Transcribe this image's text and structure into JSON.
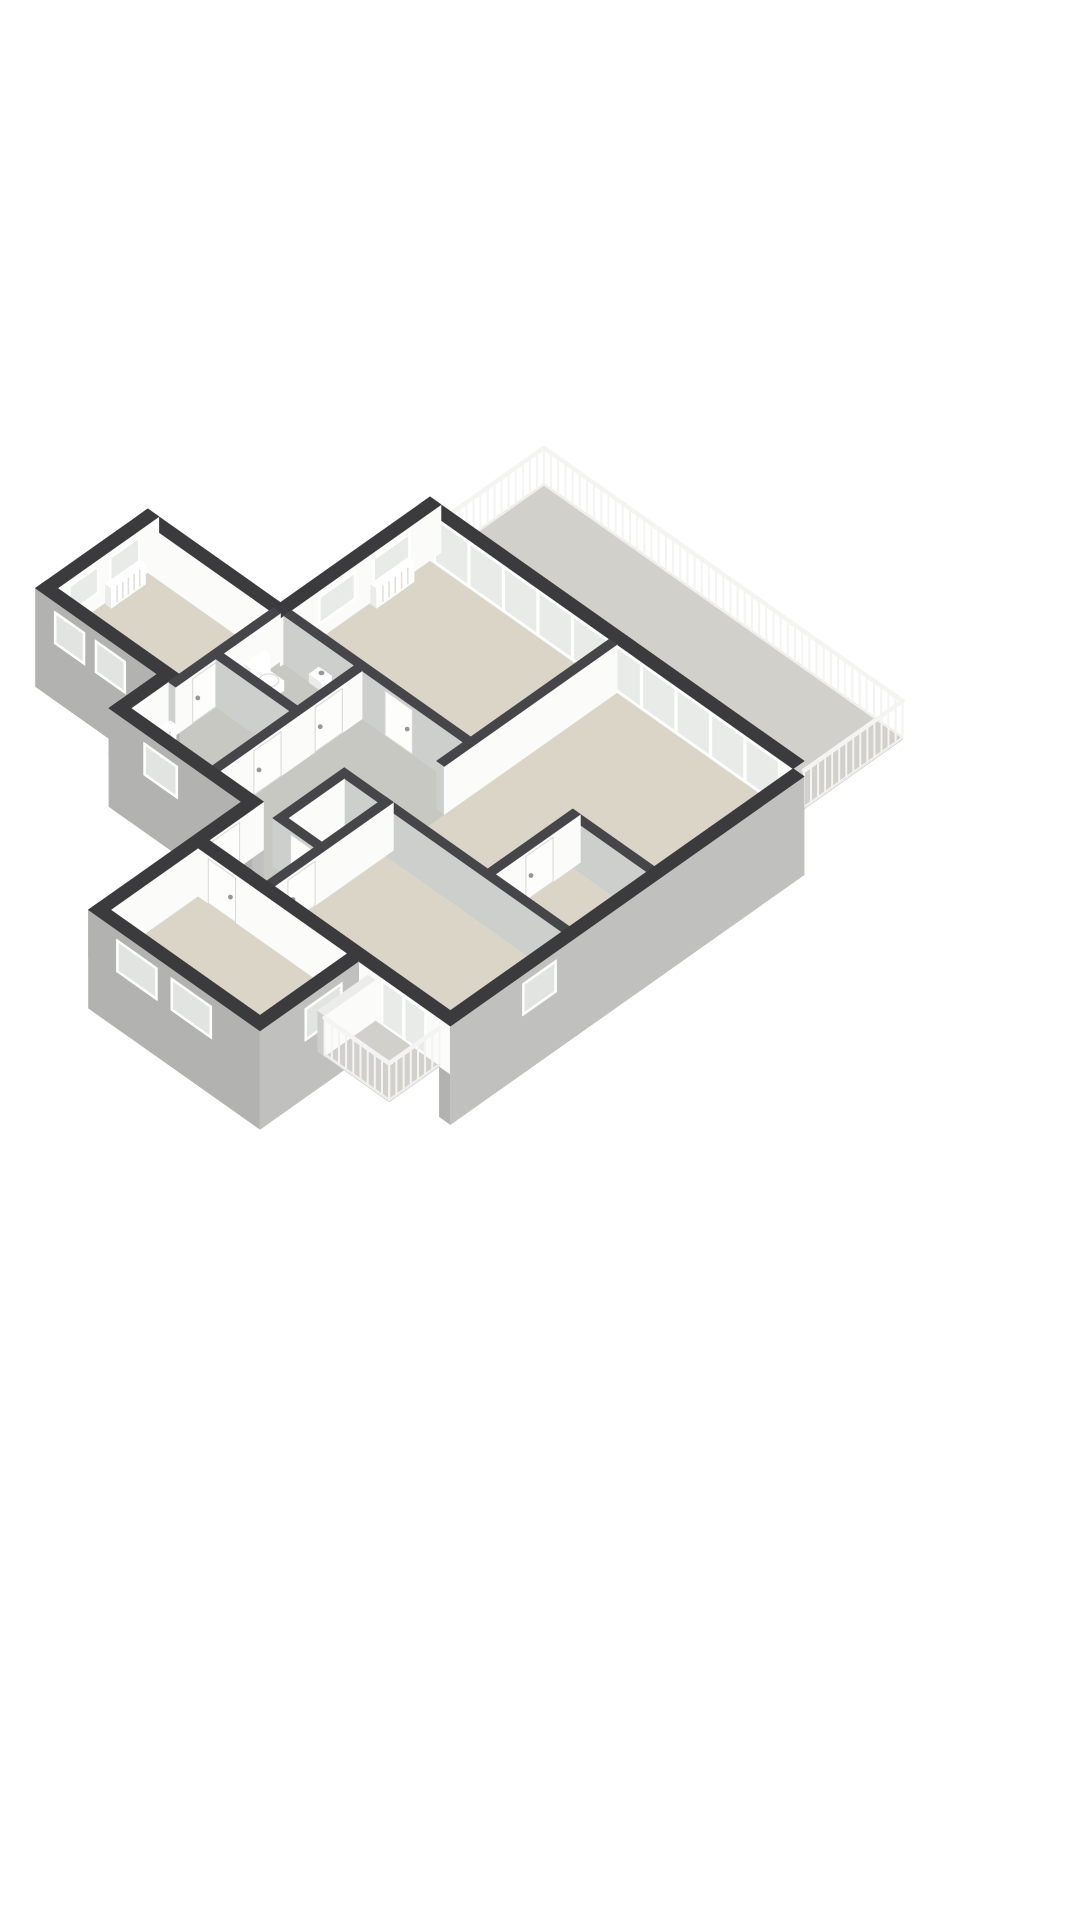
{
  "page": {
    "background": "#ffffff",
    "kind": "3d-floorplan-render"
  },
  "projection": {
    "cx": 430,
    "cy": 545,
    "kx": 34,
    "ky": 24,
    "wall_px": 48
  },
  "colors": {
    "wallTop": "#3b3b3d",
    "wallTopInt": "#46464a",
    "faceWhite": "#fbfbfa",
    "faceLight": "#cdcfcd",
    "extGraySW": "#b2b2b0",
    "extGraySE": "#c0c0be",
    "floorRoom": "#dad5c7",
    "floorWet": "#c7c8c1",
    "floorOut": "#d1d0ca",
    "glass": "#e9ebe9",
    "glassExt": "#e2e4e2",
    "frame": "#ffffff",
    "slabEdge": "#ececea",
    "railing": "#f4f4f3",
    "doorLeaf": "#fdfdfc",
    "doorEdge": "#d8d8d5",
    "handle": "#97979a",
    "fixture": "#ffffff",
    "fixtureShade": "#ebebe9",
    "radSlat": "#dededb"
  },
  "elements": [
    {
      "t": "floor",
      "name": "terrace-floor",
      "pts": [
        [
          0.45,
          0
        ],
        [
          11,
          0
        ],
        [
          11,
          -2.9
        ],
        [
          0.45,
          -2.9
        ]
      ],
      "fill": "floorOut"
    },
    {
      "t": "railing",
      "name": "terrace-railing",
      "pts": [
        [
          0.45,
          0
        ],
        [
          0.45,
          -2.9
        ],
        [
          11,
          -2.9
        ],
        [
          11,
          0
        ]
      ],
      "z1": 0.8,
      "step": 0.21
    },
    {
      "t": "floor",
      "name": "sitting-room-floor",
      "pts": [
        [
          0,
          0
        ],
        [
          5.82,
          0
        ],
        [
          5.82,
          4.62
        ],
        [
          0,
          4.62
        ]
      ],
      "fill": "floorRoom"
    },
    {
      "t": "floor",
      "name": "living-room-floor",
      "pts": [
        [
          5.6,
          0
        ],
        [
          11,
          0
        ],
        [
          11,
          6.9
        ],
        [
          5.6,
          6.9
        ]
      ],
      "fill": "floorRoom"
    },
    {
      "t": "floor",
      "name": "bedroom1-floor",
      "pts": [
        [
          -3.9,
          4.4
        ],
        [
          0.22,
          4.4
        ],
        [
          0.22,
          7.7
        ],
        [
          -3.9,
          7.7
        ]
      ],
      "fill": "floorRoom"
    },
    {
      "t": "floor",
      "name": "wc-floor",
      "pts": [
        [
          0,
          4.4
        ],
        [
          2.62,
          4.4
        ],
        [
          2.62,
          6.52
        ],
        [
          0,
          6.52
        ]
      ],
      "fill": "floorWet"
    },
    {
      "t": "floor",
      "name": "bathroom-floor",
      "pts": [
        [
          0,
          6.3
        ],
        [
          2.62,
          6.3
        ],
        [
          2.62,
          8.8
        ],
        [
          0,
          8.8
        ]
      ],
      "fill": "floorWet"
    },
    {
      "t": "floor",
      "name": "hallway-floor",
      "pts": [
        [
          2.4,
          4.4
        ],
        [
          5.82,
          4.4
        ],
        [
          5.82,
          8.8
        ],
        [
          2.4,
          8.8
        ]
      ],
      "fill": "floorWet"
    },
    {
      "t": "floor",
      "name": "corridor-floor",
      "pts": [
        [
          3.9,
          8.8
        ],
        [
          5.82,
          8.8
        ],
        [
          5.82,
          10.4
        ],
        [
          3.9,
          10.4
        ]
      ],
      "fill": "floorWet"
    },
    {
      "t": "floor",
      "name": "storage-floor",
      "pts": [
        [
          4.38,
          6.9
        ],
        [
          5.82,
          6.9
        ],
        [
          5.82,
          9
        ],
        [
          4.38,
          9
        ]
      ],
      "fill": "floorWet"
    },
    {
      "t": "floor",
      "name": "bedroom2-floor",
      "pts": [
        [
          5.6,
          6.9
        ],
        [
          11,
          6.9
        ],
        [
          11,
          10.4
        ],
        [
          5.6,
          10.4
        ]
      ],
      "fill": "floorRoom"
    },
    {
      "t": "floor",
      "name": "bedroom3-floor",
      "pts": [
        [
          3.9,
          10.4
        ],
        [
          8.3,
          10.4
        ],
        [
          8.3,
          13.3
        ],
        [
          3.9,
          13.3
        ]
      ],
      "fill": "floorRoom"
    },
    {
      "t": "box",
      "name": "wall-ne-glazed",
      "u1": 0,
      "v1": 0,
      "u2": 11,
      "v2": 0.32,
      "z0": 0,
      "z1": 1,
      "top": "wallTop",
      "sw": "faceWhite",
      "se": null
    },
    {
      "t": "panels",
      "name": "terrace-glazing",
      "axis": "u",
      "at": 0.32,
      "from": 0.45,
      "to": 10.6,
      "n": 10,
      "z0": 0.02,
      "z1": 0.96,
      "frame": "frame",
      "glass": "glass"
    },
    {
      "t": "box",
      "name": "wall-nw-main",
      "u1": 0,
      "v1": 0,
      "u2": 0.32,
      "v2": 4.72,
      "z0": 0,
      "z1": 1,
      "top": "wallTop",
      "se": "faceWhite",
      "sw": "faceLight"
    },
    {
      "t": "window",
      "name": "sitting-window-1",
      "axis": "v",
      "at": 0.32,
      "from": 0.9,
      "to": 2.0,
      "z0": 0.28,
      "z1": 0.88,
      "frame": "frame",
      "glass": "glass"
    },
    {
      "t": "window",
      "name": "sitting-window-2",
      "axis": "v",
      "at": 0.32,
      "from": 2.5,
      "to": 3.6,
      "z0": 0.28,
      "z1": 0.88,
      "frame": "frame",
      "glass": "glass"
    },
    {
      "t": "radiator",
      "name": "radiator-sitting-room",
      "axis": "v",
      "at": 0.36,
      "from": 1.0,
      "to": 2.1,
      "z1": 0.42
    },
    {
      "t": "box",
      "name": "wall-wing-ne",
      "u1": -3.9,
      "v1": 4.4,
      "u2": 0,
      "v2": 4.72,
      "z0": 0,
      "z1": 1,
      "top": "wallTop",
      "sw": "faceWhite",
      "se": null
    },
    {
      "t": "box",
      "name": "wall-wing-nw",
      "u1": -3.9,
      "v1": 4.4,
      "u2": -3.58,
      "v2": 7.7,
      "z0": 0,
      "z1": 1,
      "top": "wallTop",
      "se": "faceWhite",
      "sw": null
    },
    {
      "t": "window",
      "name": "bedroom1-window-1",
      "axis": "v",
      "at": -3.58,
      "from": 4.95,
      "to": 5.85,
      "z0": 0.28,
      "z1": 0.88,
      "frame": "frame",
      "glass": "glass"
    },
    {
      "t": "window",
      "name": "bedroom1-window-2",
      "axis": "v",
      "at": -3.58,
      "from": 6.15,
      "to": 7.05,
      "z0": 0.28,
      "z1": 0.88,
      "frame": "frame",
      "glass": "glass"
    },
    {
      "t": "radiator",
      "name": "radiator-bedroom1",
      "axis": "v",
      "at": -3.54,
      "from": 5.0,
      "to": 6.0,
      "z1": 0.42
    },
    {
      "t": "box",
      "name": "wall-wing-sw-facade",
      "u1": -3.9,
      "v1": 7.38,
      "u2": 0.32,
      "v2": 7.7,
      "z0": -1.05,
      "z1": 1,
      "top": "wallTop",
      "sw": "extGraySW",
      "se": null
    },
    {
      "t": "window",
      "name": "facade-window-west-1",
      "axis": "u",
      "at": 7.7,
      "from": -3.35,
      "to": -2.45,
      "z0": 0.12,
      "z1": 0.8,
      "frame": "frame",
      "glass": "glassExt"
    },
    {
      "t": "window",
      "name": "facade-window-west-2",
      "axis": "u",
      "at": 7.7,
      "from": -2.15,
      "to": -1.25,
      "z0": 0.12,
      "z1": 0.8,
      "frame": "frame",
      "glass": "glassExt"
    },
    {
      "t": "box",
      "name": "wall-wc-west",
      "u1": 0,
      "v1": 4.62,
      "u2": 0.22,
      "v2": 7.7,
      "z0": 0,
      "z1": 1,
      "top": "wallTopInt",
      "se": "faceWhite",
      "sw": "faceLight"
    },
    {
      "t": "door",
      "name": "door-bedroom1",
      "axis": "v",
      "at": 0.22,
      "from": 6.4,
      "to": 7.2,
      "z1": 0.92
    },
    {
      "t": "box",
      "name": "wall-hall-north",
      "u1": 0.32,
      "v1": 4.4,
      "u2": 5.82,
      "v2": 4.62,
      "z0": 0,
      "z1": 1,
      "top": "wallTopInt",
      "sw": "faceLight",
      "se": null
    },
    {
      "t": "door",
      "name": "door-sitting-room",
      "axis": "u",
      "at": 4.62,
      "from": 3.3,
      "to": 4.1,
      "z1": 0.92
    },
    {
      "t": "box",
      "name": "toilet-cistern",
      "u1": 0.24,
      "v1": 5.12,
      "u2": 0.42,
      "v2": 5.68,
      "z0": 0,
      "z1": 0.48,
      "top": "fixture",
      "se": "fixture",
      "sw": "fixtureShade"
    },
    {
      "t": "box",
      "name": "toilet-bowl",
      "u1": 0.42,
      "v1": 5.18,
      "u2": 0.88,
      "v2": 5.62,
      "z0": 0,
      "z1": 0.2,
      "top": "fixture",
      "se": "fixture",
      "sw": "fixtureShade"
    },
    {
      "t": "disk",
      "name": "toilet-seat",
      "u": 0.66,
      "v": 5.4,
      "z": 0.21,
      "rx": 10,
      "ry": 6.5,
      "fill": "fixture",
      "stroke": "doorEdge"
    },
    {
      "t": "box",
      "name": "wc-basin",
      "u1": 1.35,
      "v1": 4.62,
      "u2": 1.72,
      "v2": 4.9,
      "z0": 0.26,
      "z1": 0.44,
      "top": "fixture",
      "se": "fixture",
      "sw": "fixtureShade"
    },
    {
      "t": "disk",
      "name": "basin-tap",
      "u": 1.53,
      "v": 4.72,
      "z": 0.46,
      "rx": 2.5,
      "ry": 1.8,
      "fill": "handle",
      "stroke": "handle"
    },
    {
      "t": "box",
      "name": "wall-sitting-living",
      "u1": 5.6,
      "v1": 0.32,
      "u2": 5.82,
      "v2": 5.4,
      "z0": 0,
      "z1": 1,
      "top": "wallTopInt",
      "se": "faceWhite",
      "sw": "faceLight"
    },
    {
      "t": "box",
      "name": "closet-wall-nw",
      "u1": 8.82,
      "v1": 4.4,
      "u2": 11,
      "v2": 4.62,
      "z0": 0,
      "z1": 1,
      "top": "wallTopInt",
      "sw": "faceLight",
      "se": null
    },
    {
      "t": "box",
      "name": "closet-wall-west",
      "u1": 8.6,
      "v1": 4.4,
      "u2": 8.82,
      "v2": 6.9,
      "z0": 0,
      "z1": 1,
      "top": "wallTopInt",
      "se": "faceWhite",
      "sw": "faceLight"
    },
    {
      "t": "door",
      "name": "door-closet",
      "axis": "v",
      "at": 8.82,
      "from": 5.2,
      "to": 6.0,
      "z1": 0.92
    },
    {
      "t": "box",
      "name": "wall-wc-bath",
      "u1": 0.22,
      "v1": 6.3,
      "u2": 2.4,
      "v2": 6.52,
      "z0": 0,
      "z1": 1,
      "top": "wallTopInt",
      "sw": "faceLight",
      "se": null
    },
    {
      "t": "box",
      "name": "wall-wet-east",
      "u1": 2.4,
      "v1": 4.62,
      "u2": 2.62,
      "v2": 8.8,
      "z0": 0,
      "z1": 1,
      "top": "wallTopInt",
      "se": "faceWhite",
      "sw": "faceLight"
    },
    {
      "t": "door",
      "name": "door-wc",
      "axis": "v",
      "at": 2.62,
      "from": 5.2,
      "to": 6.0,
      "z1": 0.92
    },
    {
      "t": "door",
      "name": "door-bathroom",
      "axis": "v",
      "at": 2.62,
      "from": 7.0,
      "to": 7.8,
      "z1": 0.92
    },
    {
      "t": "box",
      "name": "storage-wall-north",
      "u1": 4.38,
      "v1": 6.9,
      "u2": 5.82,
      "v2": 7.12,
      "z0": 0,
      "z1": 1,
      "top": "wallTopInt",
      "sw": "faceLight",
      "se": null
    },
    {
      "t": "box",
      "name": "storage-wall-west",
      "u1": 4.38,
      "v1": 7.12,
      "u2": 4.6,
      "v2": 9,
      "z0": 0,
      "z1": 1,
      "top": "wallTopInt",
      "se": "faceWhite",
      "sw": "faceLight"
    },
    {
      "t": "box",
      "name": "storage-wall-south",
      "u1": 4.6,
      "v1": 8.78,
      "u2": 5.82,
      "v2": 9,
      "z0": 0,
      "z1": 1,
      "top": "wallTopInt",
      "sw": "faceLight",
      "se": null
    },
    {
      "t": "door",
      "name": "door-storage",
      "axis": "u",
      "at": 9,
      "from": 4.9,
      "to": 5.6,
      "z1": 0.92
    },
    {
      "t": "box",
      "name": "wall-living-bedroom2",
      "u1": 5.82,
      "v1": 6.9,
      "u2": 11,
      "v2": 7.12,
      "z0": 0,
      "z1": 1,
      "top": "wallTopInt",
      "sw": "faceLight",
      "se": null
    },
    {
      "t": "box",
      "name": "wall-bedroom2-west",
      "u1": 5.6,
      "v1": 6.9,
      "u2": 5.82,
      "v2": 10.4,
      "z0": 0,
      "z1": 1,
      "top": "wallTopInt",
      "se": "faceWhite",
      "sw": "faceLight"
    },
    {
      "t": "door",
      "name": "door-bedroom2",
      "axis": "v",
      "at": 5.82,
      "from": 9.2,
      "to": 10.0,
      "z1": 0.92
    },
    {
      "t": "box",
      "name": "wall-bath-west",
      "u1": -0.32,
      "v1": 7.7,
      "u2": 0,
      "v2": 9.12,
      "z0": 0,
      "z1": 1,
      "top": "wallTop",
      "se": "faceWhite",
      "sw": "extGraySW"
    },
    {
      "t": "radiator",
      "name": "radiator-bathroom",
      "axis": "v",
      "at": 0.26,
      "from": 7.9,
      "to": 8.6,
      "z1": 0.42
    },
    {
      "t": "box",
      "name": "wall-sw-left-facade",
      "u1": -0.32,
      "v1": 8.8,
      "u2": 3.9,
      "v2": 9.12,
      "z0": -1.05,
      "z1": 1,
      "top": "wallTop",
      "sw": "extGraySW",
      "se": "extGraySE"
    },
    {
      "t": "window",
      "name": "facade-window-west-3",
      "axis": "u",
      "at": 9.12,
      "from": 0.7,
      "to": 1.7,
      "z0": 0.12,
      "z1": 0.8,
      "frame": "frame",
      "glass": "glassExt"
    },
    {
      "t": "box",
      "name": "wall-west-corridor",
      "u1": 3.58,
      "v1": 8.8,
      "u2": 3.9,
      "v2": 13.62,
      "z0": 0,
      "z1": 1,
      "top": "wallTop",
      "se": "faceWhite",
      "sw": "extGraySW"
    },
    {
      "t": "door",
      "name": "front-door",
      "axis": "v",
      "at": 3.9,
      "from": 9.5,
      "to": 10.3,
      "z1": 0.92
    },
    {
      "t": "box",
      "name": "wall-se-facade",
      "u1": 11,
      "v1": 0.32,
      "u2": 11.32,
      "v2": 10.72,
      "z0": -1.05,
      "z1": 1,
      "top": "wallTop",
      "se": "extGraySE",
      "sw": "extGraySW"
    },
    {
      "t": "window",
      "name": "facade-window-east-1",
      "axis": "v",
      "at": 11.32,
      "from": 7.6,
      "to": 8.6,
      "z0": 0.15,
      "z1": 0.82,
      "frame": "frame",
      "glass": "glassExt"
    },
    {
      "t": "box",
      "name": "wall-sw-bedroom2",
      "u1": 3.9,
      "v1": 10.4,
      "u2": 11.32,
      "v2": 10.72,
      "z0": 0,
      "z1": 1,
      "top": "wallTop",
      "sw": "faceWhite",
      "se": "extGraySE"
    },
    {
      "t": "door",
      "name": "door-bedroom3",
      "axis": "u",
      "at": 10.72,
      "from": 4.2,
      "to": 5.0,
      "z1": 0.92
    },
    {
      "t": "panels",
      "name": "balcony-glass-door",
      "axis": "u",
      "at": 10.72,
      "from": 9.3,
      "to": 10.6,
      "n": 2,
      "z0": 0.02,
      "z1": 0.95,
      "frame": "frame",
      "glass": "glass"
    },
    {
      "t": "radiator",
      "name": "radiator-bedroom3",
      "axis": "u",
      "at": 13.06,
      "from": 4.6,
      "to": 5.6,
      "z1": 0.42
    },
    {
      "t": "box",
      "name": "wall-se-wing2-facade",
      "u1": 8.3,
      "v1": 10.72,
      "u2": 8.62,
      "v2": 13.62,
      "z0": -1.05,
      "z1": 1,
      "top": "wallTop",
      "se": "extGraySE",
      "sw": null
    },
    {
      "t": "window",
      "name": "facade-window-east-2",
      "axis": "v",
      "at": 8.62,
      "from": 11.2,
      "to": 12.3,
      "z0": 0.12,
      "z1": 0.8,
      "frame": "frame",
      "glass": "glassExt"
    },
    {
      "t": "box",
      "name": "wall-sw-wing2-facade",
      "u1": 3.58,
      "v1": 13.3,
      "u2": 8.62,
      "v2": 13.62,
      "z0": -1.05,
      "z1": 1,
      "top": "wallTop",
      "sw": "extGraySW",
      "se": "extGraySE"
    },
    {
      "t": "window",
      "name": "facade-window-south-1",
      "axis": "u",
      "at": 13.62,
      "from": 4.4,
      "to": 5.6,
      "z0": 0.12,
      "z1": 0.8,
      "frame": "frame",
      "glass": "glassExt"
    },
    {
      "t": "window",
      "name": "facade-window-south-2",
      "axis": "u",
      "at": 13.62,
      "from": 6.0,
      "to": 7.2,
      "z0": 0.12,
      "z1": 0.8,
      "frame": "frame",
      "glass": "glassExt"
    },
    {
      "t": "floor",
      "name": "balcony-floor",
      "pts": [
        [
          8.9,
          10.72
        ],
        [
          11,
          10.72
        ],
        [
          11,
          12.2
        ],
        [
          8.9,
          12.2
        ]
      ],
      "fill": "floorOut"
    },
    {
      "t": "box",
      "name": "balcony-side-wall",
      "u1": 8.9,
      "v1": 10.72,
      "u2": 9.1,
      "v2": 12.2,
      "z0": 0,
      "z1": 0.85,
      "top": "slabEdge",
      "se": "faceWhite",
      "sw": "faceLight"
    },
    {
      "t": "railing",
      "name": "balcony-railing",
      "pts": [
        [
          9.1,
          12.2
        ],
        [
          11,
          12.2
        ],
        [
          11,
          10.72
        ]
      ],
      "z1": 0.8,
      "step": 0.21
    }
  ]
}
